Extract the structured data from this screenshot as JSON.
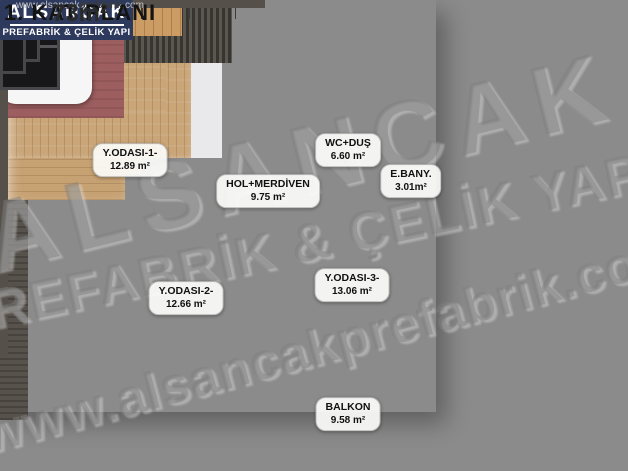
{
  "plan": {
    "rooms": [
      {
        "id": "bedroom-1",
        "name": "Y.ODASI-1-",
        "area": "12.89 m²"
      },
      {
        "id": "hall-stairs",
        "name": "HOL+MERDİVEN",
        "area": "9.75 m²"
      },
      {
        "id": "wc-shower",
        "name": "WC+DUŞ",
        "area": "6.60 m²"
      },
      {
        "id": "ensuite-bath",
        "name": "E.BANY.",
        "area": "3.01m²"
      },
      {
        "id": "bedroom-2",
        "name": "Y.ODASI-2-",
        "area": "12.66 m²"
      },
      {
        "id": "bedroom-3",
        "name": "Y.ODASI-3-",
        "area": "13.06 m²"
      },
      {
        "id": "balcony",
        "name": "BALKON",
        "area": "9.58 m²"
      }
    ]
  },
  "watermark": {
    "line1": "ALSANCAK",
    "line2": "PREFABRİK & ÇELİK YAPI",
    "line3": "www.alsancakprefabrik.com"
  },
  "branding": {
    "logo_title": "ALSANCAK",
    "logo_subtitle": "PREFABRİK & ÇELİK YAPI",
    "website_prefix": "www.alsancak",
    "website_bold": "prefabrik",
    "website_suffix": ".com",
    "plan_title": "1. KAT PLANI",
    "plan_area": "73m²"
  },
  "colors": {
    "brand_navy": "#2d3a5e",
    "background_gray": "#8b8b8b",
    "wall_dark": "#56504a",
    "wood_floor": "#c9a578",
    "accent_maroon": "#9d5e60"
  }
}
